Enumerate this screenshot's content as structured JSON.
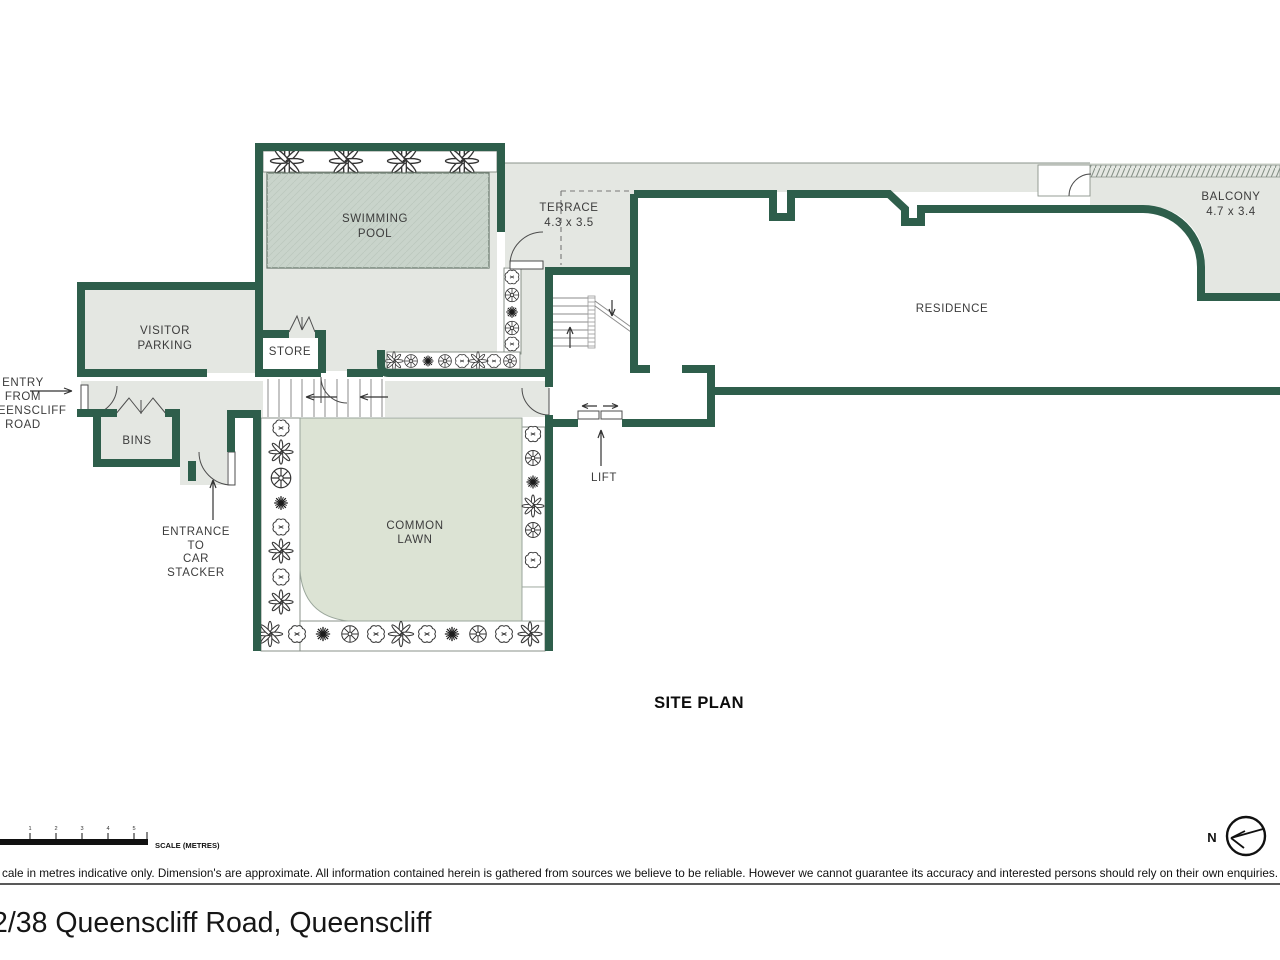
{
  "plan": {
    "title": "SITE PLAN",
    "labels": {
      "swimming_pool": [
        "SWIMMING",
        "POOL"
      ],
      "terrace": [
        "TERRACE",
        "4.3 x 3.5"
      ],
      "balcony": [
        "BALCONY",
        "4.7 x 3.4"
      ],
      "residence": "RESIDENCE",
      "visitor_parking": [
        "VISITOR",
        "PARKING"
      ],
      "store": "STORE",
      "bins": "BINS",
      "entry": [
        "ENTRY",
        "FROM",
        "QUEENSCLIFF",
        "ROAD"
      ],
      "car_stacker": [
        "ENTRANCE",
        "TO",
        "CAR",
        "STACKER"
      ],
      "common_lawn": [
        "COMMON",
        "LAWN"
      ],
      "lift": "LIFT"
    }
  },
  "scale_bar": {
    "label": "SCALE (METRES)",
    "ticks": [
      "1",
      "2",
      "3",
      "4",
      "5"
    ]
  },
  "compass": {
    "north_label": "N"
  },
  "footer": {
    "disclaimer": "cale in metres indicative only. Dimension's are approximate. All information contained herein is gathered from sources we believe to be reliable. However we cannot guarantee its accuracy and interested persons should rely on their own enquiries.",
    "address": "2/38 Queenscliff Road, Queenscliff"
  },
  "colors": {
    "wall": "#2e5e4b",
    "floor": "#e4e7e2",
    "lawn": "#dce3d4",
    "pool_water": "#c9d4cb",
    "label_text": "#3c3c3c"
  }
}
